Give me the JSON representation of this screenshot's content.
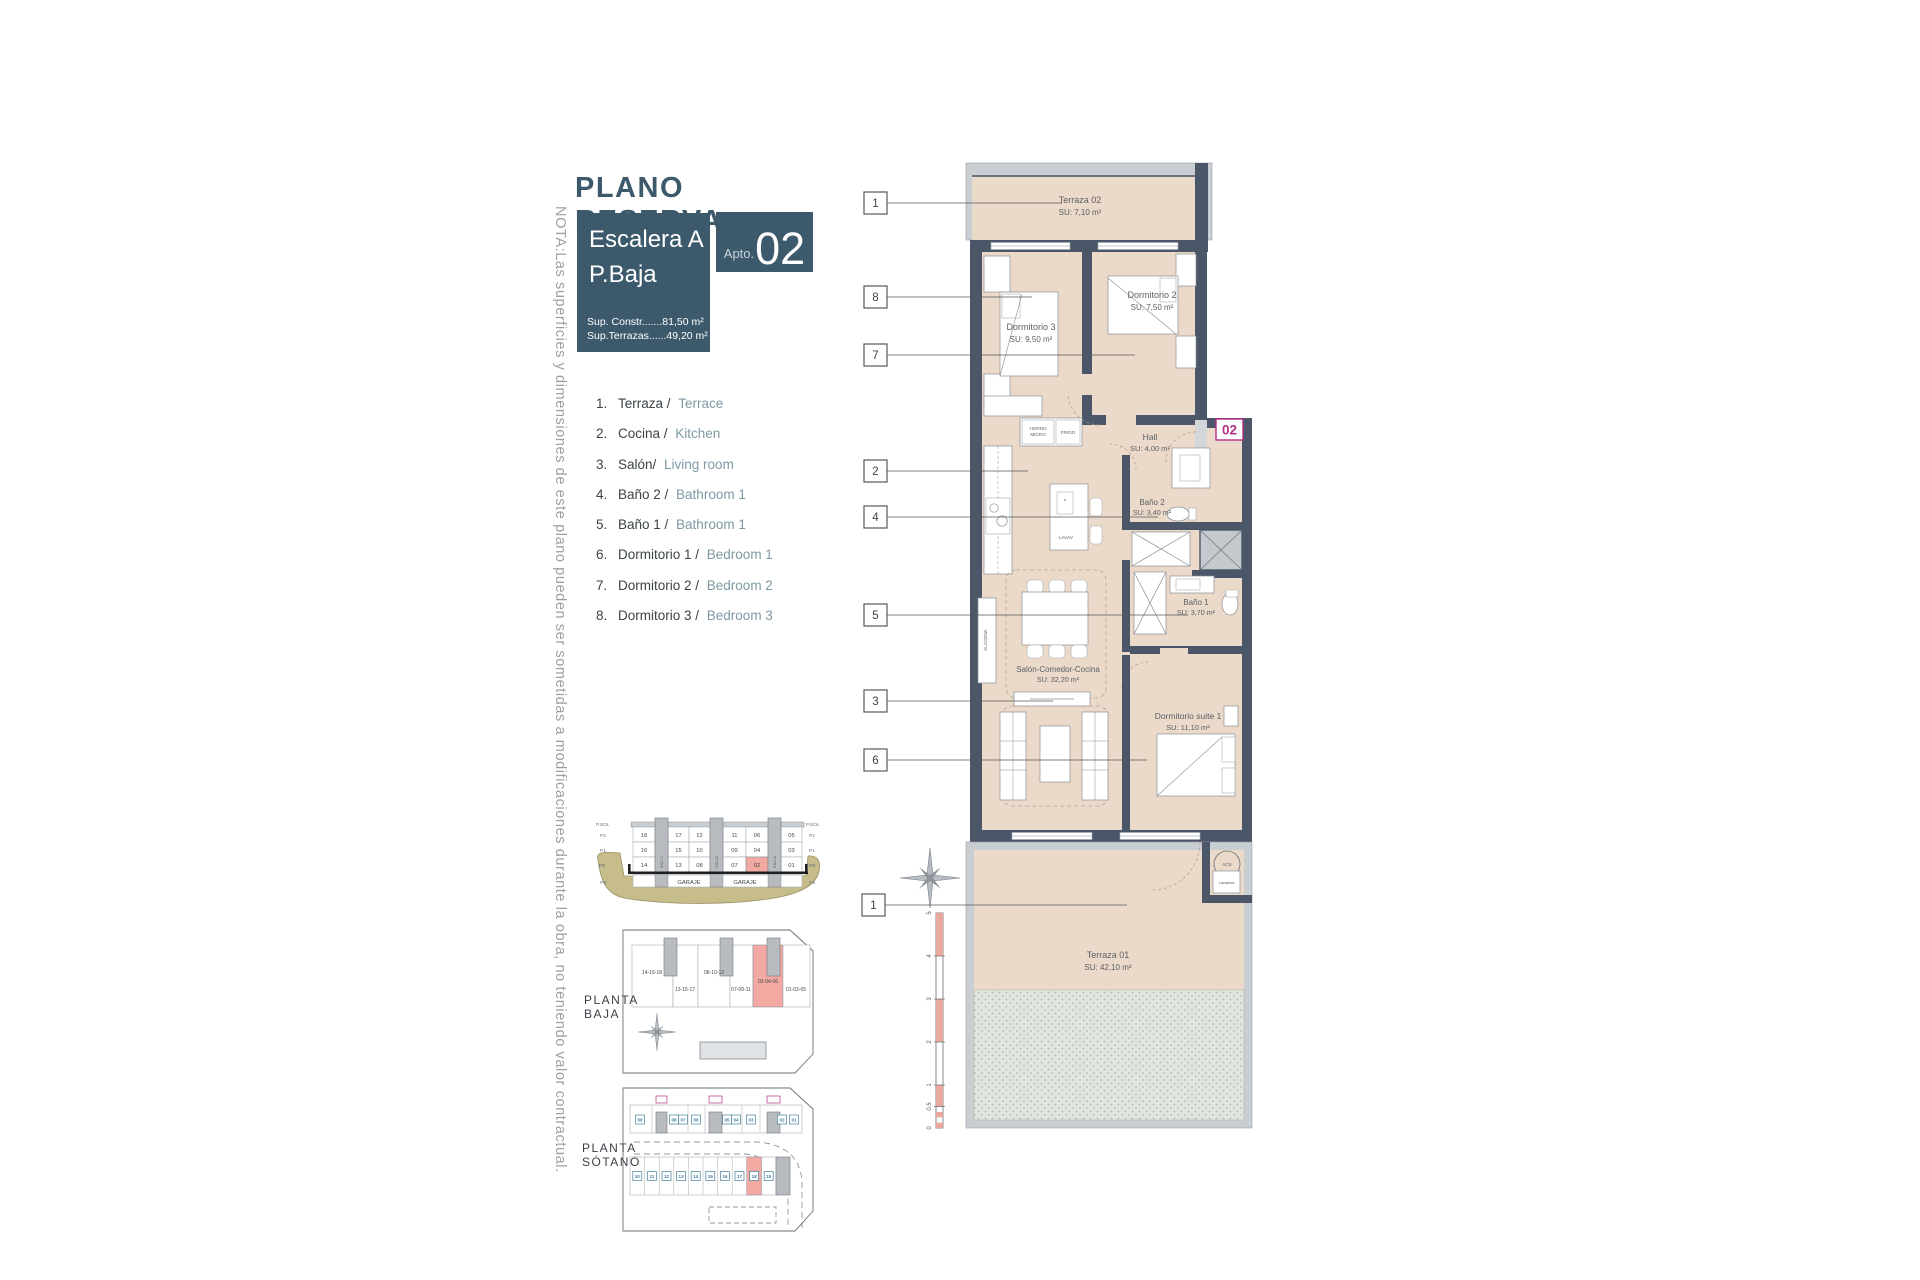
{
  "note_vertical": "NOTA:Las superficies y dimensiones de este plano pueden ser sometidas a modificaciones durante la obra, no teniendo valor contractual.",
  "title": "PLANO RESERVA",
  "info_box": {
    "line1": "Escalera A",
    "line2": "P.Baja",
    "sup_constr": "Sup. Constr.......81,50 m²",
    "sup_terrazas": "Sup.Terrazas......49,20 m²"
  },
  "apto": {
    "label": "Apto.",
    "number": "02"
  },
  "legend": {
    "items": [
      {
        "num": "1.",
        "es": "Terraza / ",
        "en": "Terrace"
      },
      {
        "num": "2.",
        "es": "Cocina / ",
        "en": "Kitchen"
      },
      {
        "num": "3.",
        "es": "Salón/ ",
        "en": "Living room"
      },
      {
        "num": "4.",
        "es": "Baño 2 / ",
        "en": "Bathroom 1"
      },
      {
        "num": "5.",
        "es": "Baño 1 / ",
        "en": "Bathroom 1"
      },
      {
        "num": "6.",
        "es": "Dormitorio 1 / ",
        "en": "Bedroom 1"
      },
      {
        "num": "7.",
        "es": "Dormitorio 2 / ",
        "en": "Bedroom 2"
      },
      {
        "num": "8.",
        "es": "Dormitorio 3 / ",
        "en": "Bedroom 3"
      }
    ]
  },
  "plan": {
    "badge": "02",
    "rooms": [
      {
        "name": "Terraza 02",
        "area": "SU: 7,10 m²"
      },
      {
        "name": "Dormitorio 3",
        "area": "SU: 9,50 m²"
      },
      {
        "name": "Dormitorio 2",
        "area": "SU: 7,50 m²"
      },
      {
        "name": "Hall",
        "area": "SU: 4,00 m²"
      },
      {
        "name": "Baño 2",
        "area": "SU: 3,40 m²"
      },
      {
        "name": "Baño 1",
        "area": "SU: 3,70 m²"
      },
      {
        "name": "Salón-Comedor-Cocina",
        "area": "SU: 32,20 m²"
      },
      {
        "name": "Dormitorio suite 1",
        "area": "SU: 11,10 m²"
      },
      {
        "name": "Terraza 01",
        "area": "SU: 42,10 m²"
      }
    ],
    "fixtures": {
      "horno1": "HORNO",
      "horno2": "MICRO",
      "frigo": "FRIGO",
      "lavav": "LAVAV",
      "alacena": "ALACENA",
      "acs": "ACS",
      "lavadora": "Lavadora"
    },
    "callouts": [
      "1",
      "8",
      "7",
      "2",
      "4",
      "5",
      "3",
      "6",
      "1"
    ],
    "scale_marks": [
      "5",
      "4",
      "3",
      "2",
      "1",
      "0.5",
      "0"
    ]
  },
  "section": {
    "floors_left": [
      "P.SOL",
      "P2",
      "P1",
      "PB",
      "PS"
    ],
    "floors_right": [
      "P.SOL",
      "P2",
      "P1",
      "PB",
      "PS"
    ],
    "row_p2": [
      "18",
      "17",
      "12",
      "11",
      "06",
      "05"
    ],
    "row_p1": [
      "16",
      "15",
      "10",
      "09",
      "04",
      "03"
    ],
    "row_pb": [
      "14",
      "13",
      "08",
      "07",
      "02",
      "01"
    ],
    "garage": [
      "GARAJE",
      "GARAJE"
    ],
    "cores": [
      "ESC-C",
      "ESC-B",
      "ESC-A"
    ]
  },
  "planta_baja": {
    "label1": "PLANTA",
    "label2": "BAJA",
    "units": [
      "14-16-18",
      "13-15-17",
      "08-10-12",
      "07-09-11",
      "02-04-06",
      "01-03-05"
    ]
  },
  "planta_sotano": {
    "label1": "PLANTA",
    "label2": "SÓTANO",
    "storage": [
      "09",
      "08",
      "07",
      "06",
      "05",
      "04",
      "03",
      "02",
      "01"
    ],
    "parking": [
      "10",
      "11",
      "12",
      "13",
      "14",
      "15",
      "16",
      "17",
      "18",
      "19"
    ]
  },
  "colors": {
    "brand_teal": "#3d5a6d",
    "wall": "#4b5669",
    "floor_beige": "#ebd9c9",
    "highlight_pink": "#f2a9a1",
    "badge_magenta": "#b42f86",
    "legend_en": "#7e99a3"
  }
}
